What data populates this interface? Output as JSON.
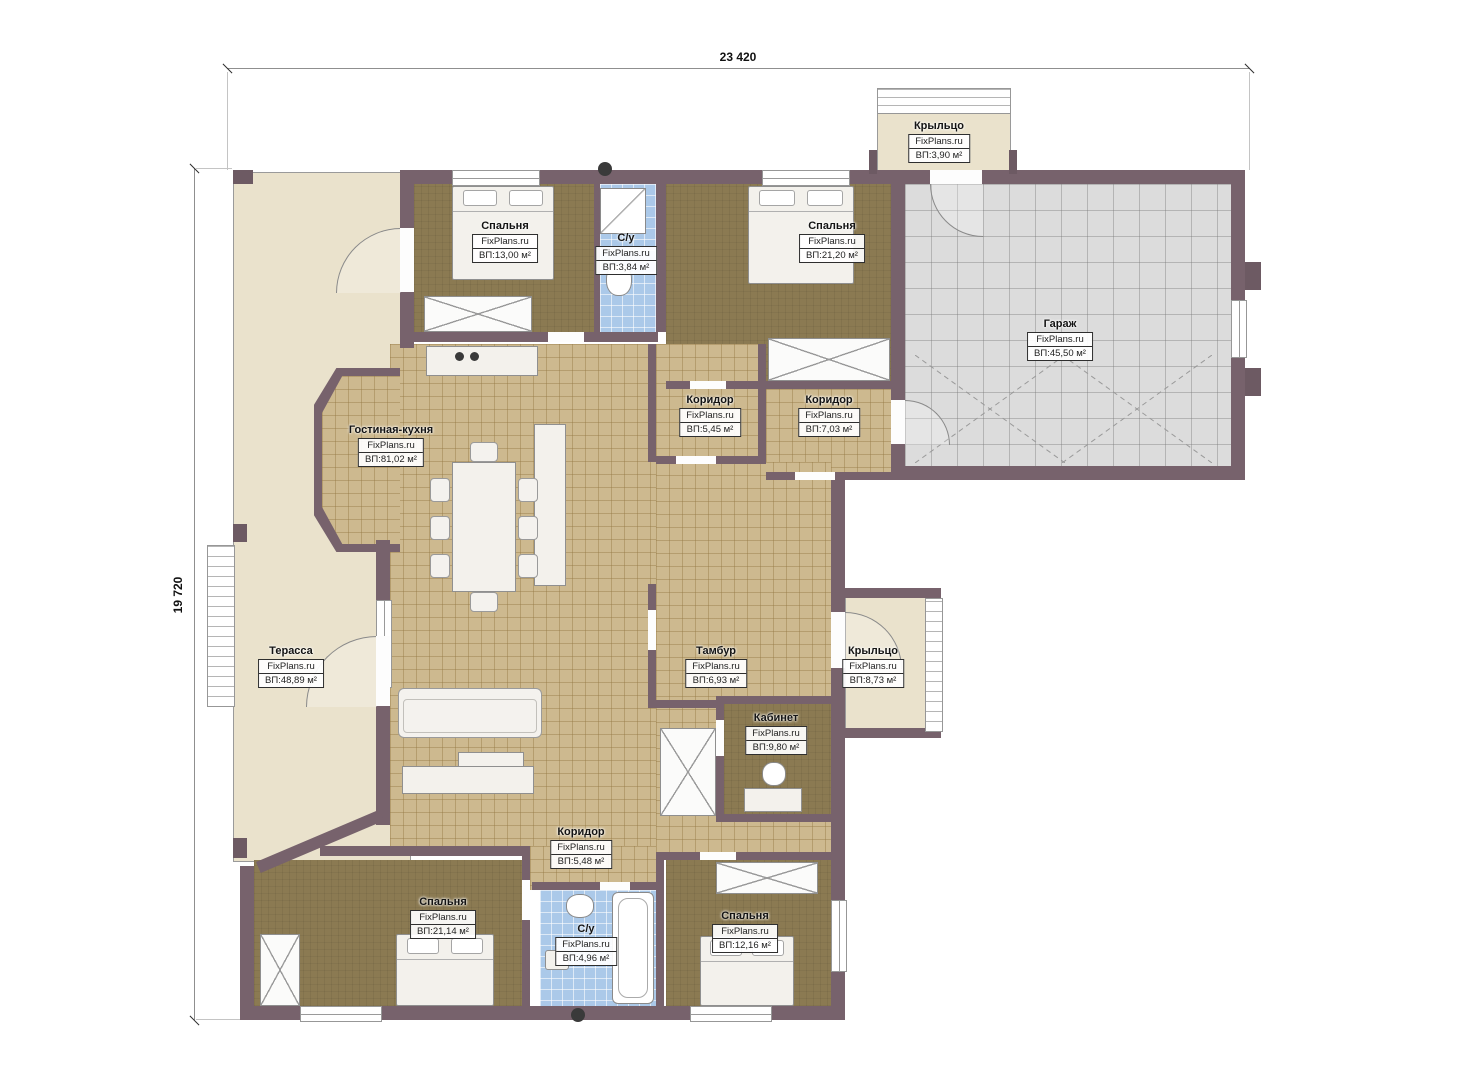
{
  "brand": "FixPlans.ru",
  "dimensions": {
    "top": "23 420",
    "left": "19 720"
  },
  "colors": {
    "wall": "#77626c",
    "floor_wood": "#8b7a52",
    "floor_tile": "#cdb98f",
    "floor_bath": "#abc9e9",
    "floor_garage": "#dcdcdc",
    "floor_terrace": "#eae2cc",
    "label_border": "#2e2e2e"
  },
  "rooms": [
    {
      "id": "bedroom-top-left",
      "name": "Спальня",
      "area": "ВП:13,00 м²"
    },
    {
      "id": "wc-top",
      "name": "С/у",
      "area": "ВП:3,84 м²"
    },
    {
      "id": "bedroom-top-right",
      "name": "Спальня",
      "area": "ВП:21,20 м²"
    },
    {
      "id": "garage",
      "name": "Гараж",
      "area": "ВП:45,50 м²"
    },
    {
      "id": "corridor-1",
      "name": "Коридор",
      "area": "ВП:5,45 м²"
    },
    {
      "id": "corridor-2",
      "name": "Коридор",
      "area": "ВП:7,03 м²"
    },
    {
      "id": "living-kitchen",
      "name": "Гостиная-кухня",
      "area": "ВП:81,02 м²"
    },
    {
      "id": "terrace",
      "name": "Терасса",
      "area": "ВП:48,89 м²"
    },
    {
      "id": "tambour",
      "name": "Тамбур",
      "area": "ВП:6,93 м²"
    },
    {
      "id": "porch-right",
      "name": "Крыльцо",
      "area": "ВП:8,73 м²"
    },
    {
      "id": "porch-top",
      "name": "Крыльцо",
      "area": "ВП:3,90 м²"
    },
    {
      "id": "office",
      "name": "Кабинет",
      "area": "ВП:9,80 м²"
    },
    {
      "id": "corridor-3",
      "name": "Коридор",
      "area": "ВП:5,48 м²"
    },
    {
      "id": "bedroom-bottom-left",
      "name": "Спальня",
      "area": "ВП:21,14 м²"
    },
    {
      "id": "wc-bottom",
      "name": "С/у",
      "area": "ВП:4,96 м²"
    },
    {
      "id": "bedroom-bottom-right",
      "name": "Спальня",
      "area": "ВП:12,16 м²"
    }
  ]
}
